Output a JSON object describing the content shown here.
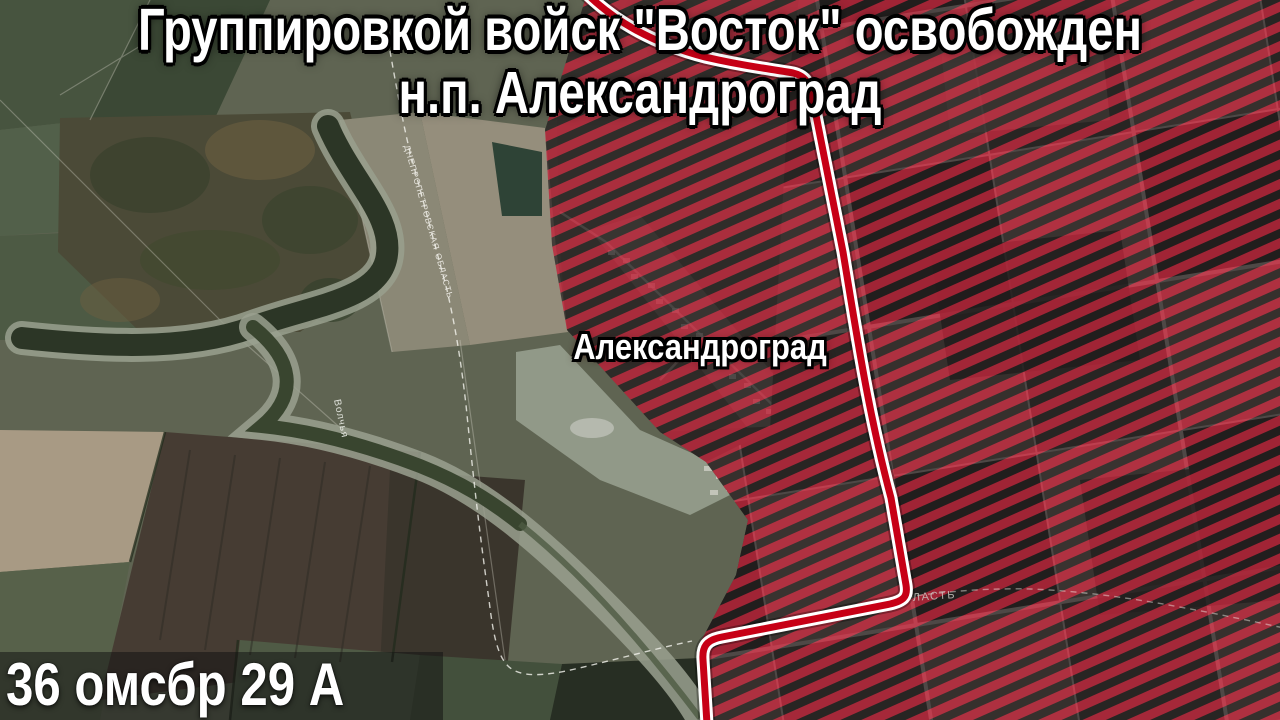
{
  "title": {
    "line1": "Группировкой войск \"Восток\" освобожден",
    "line2": "н.п. Александроград"
  },
  "map_labels": {
    "settlement": "Александроград",
    "river": "Волчья",
    "oblast_boundary": "ДНЕПРОПЕТРОВСКАЯ ОБЛАСТЬ",
    "oblast_boundary_partial": "ЛАСТЬ"
  },
  "credit": {
    "unit": "36 омсбр 29 А"
  },
  "colors": {
    "hatch_red": "#c02038",
    "hatch_dark": "#1a1416",
    "frontline_red": "#c70016",
    "frontline_casing": "#ffffff",
    "title_text": "#ffffff"
  }
}
